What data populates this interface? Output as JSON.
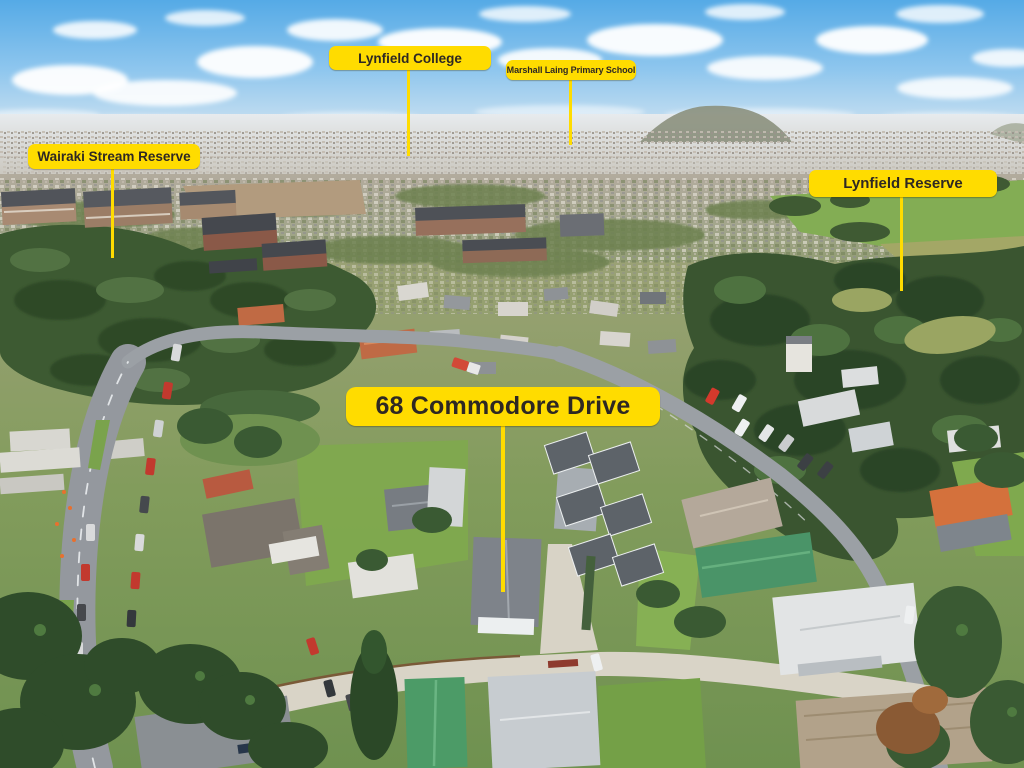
{
  "scene": {
    "type": "aerial-drone-photo",
    "subject": "suburban real-estate aerial view with place callouts",
    "palette": {
      "label_bg": "#FFDC00",
      "label_text": "#2E2823",
      "pointer_line": "#FFDC00",
      "sky_top": "#55AAE6",
      "bush_green": "#3D5A32",
      "grass_green": "#7FA94E",
      "road_gray": "#94989E"
    }
  },
  "callouts": {
    "property": {
      "label": "68 Commodore Drive"
    },
    "college": {
      "label": "Lynfield College"
    },
    "primary_school": {
      "label": "Marshall Laing Primary School"
    },
    "stream_reserve": {
      "label": "Wairaki Stream Reserve"
    },
    "reserve": {
      "label": "Lynfield Reserve"
    }
  }
}
